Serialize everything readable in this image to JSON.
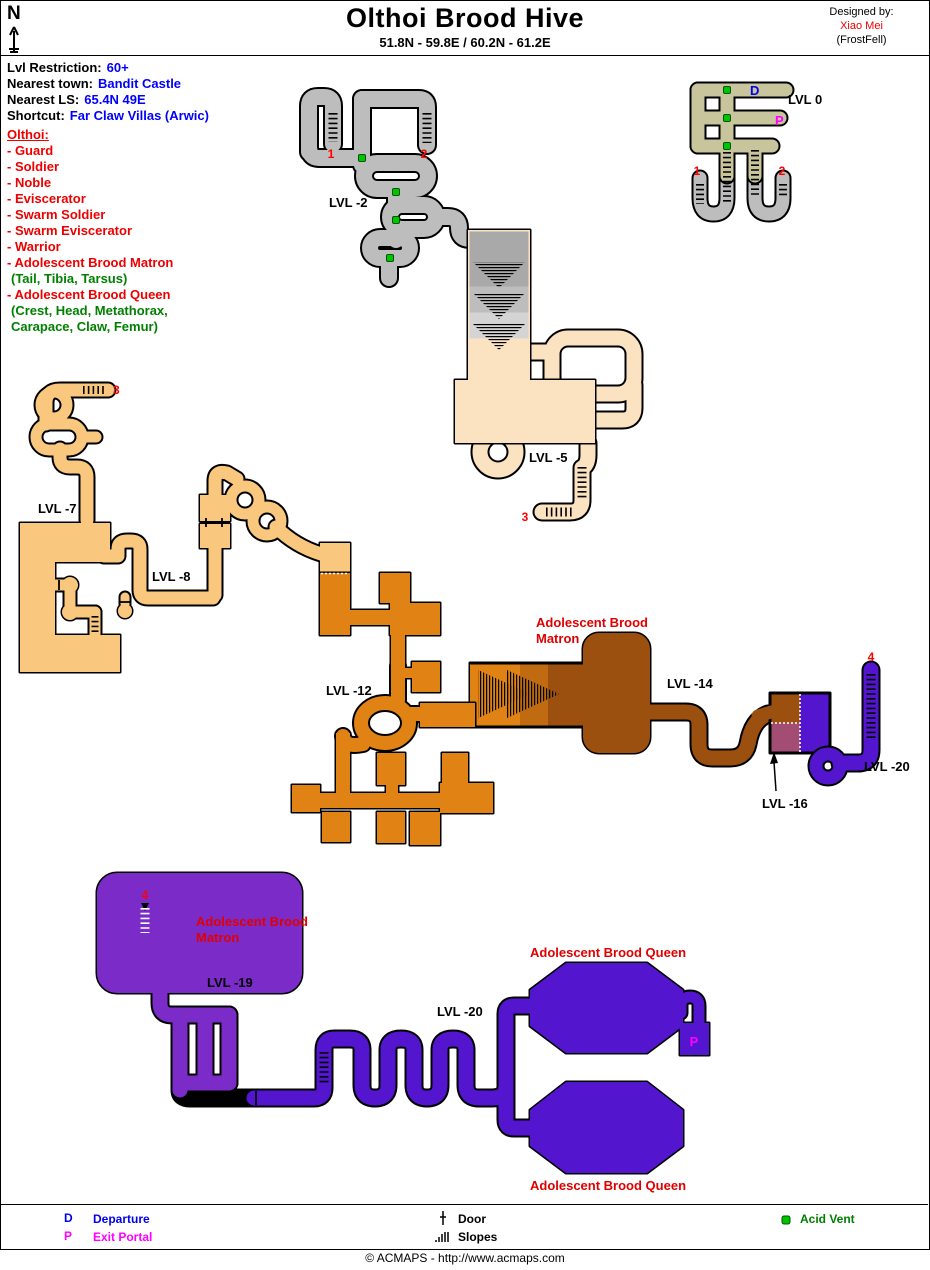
{
  "header": {
    "north_label": "N",
    "title": "Olthoi Brood Hive",
    "subtitle": "51.8N - 59.8E  /  60.2N - 61.2E",
    "designed_by_label": "Designed by:",
    "designer_name": "Xiao Mei",
    "designer_server": "(FrostFell)"
  },
  "info": {
    "restriction_label": "Lvl Restriction:",
    "restriction_value": "60+",
    "town_label": "Nearest town:",
    "town_value": "Bandit Castle",
    "ls_label": "Nearest LS:",
    "ls_value": "65.4N 49E",
    "shortcut_label": "Shortcut:",
    "shortcut_value": "Far Claw Villas (Arwic)",
    "creatures_heading": "Olthoi:",
    "creatures": [
      "- Guard",
      "- Soldier",
      "- Noble",
      "- Eviscerator",
      "- Swarm Soldier",
      "- Swarm Eviscerator",
      "- Warrior",
      "- Adolescent Brood Matron",
      "- Adolescent Brood Queen"
    ],
    "matron_drops": "(Tail, Tibia, Tarsus)",
    "queen_drops_line1": "(Crest, Head, Metathorax,",
    "queen_drops_line2": "Carapace, Claw, Femur)"
  },
  "map": {
    "labels": {
      "lvl0": "LVL 0",
      "lvl2": "LVL -2",
      "lvl5": "LVL -5",
      "lvl7": "LVL -7",
      "lvl8": "LVL -8",
      "lvl12": "LVL -12",
      "lvl14": "LVL -14",
      "lvl16": "LVL -16",
      "lvl19": "LVL -19",
      "lvl20": "LVL -20"
    },
    "area_labels": {
      "matron_line1": "Adolescent Brood",
      "matron_line2": "Matron",
      "queen": "Adolescent Brood Queen"
    },
    "markers": {
      "departure": "D",
      "exit_portal": "P",
      "slope_1": "1",
      "slope_2": "2",
      "slope_3": "3",
      "slope_4": "4"
    }
  },
  "legend": {
    "departure_key": "D",
    "departure_label": "Departure",
    "exit_key": "P",
    "exit_label": "Exit Portal",
    "door_label": "Door",
    "slopes_label": "Slopes",
    "acid_vent_label": "Acid Vent"
  },
  "footer": {
    "copyright": "© ACMAPS - http://www.acmaps.com"
  },
  "colors": {
    "lvl0": "#C8C49C",
    "lvl2": "#BDBDBD",
    "lvl5": "#FBE3C1",
    "lvl7_8": "#F9C87E",
    "lvl12": "#E08214",
    "lvl14": "#9C500F",
    "lvl16": "#A34C74",
    "lvl19": "#7B2CC8",
    "lvl20": "#5316CE",
    "marker_red": "#FF0000",
    "departure_blue": "#0000EE",
    "exit_portal_magenta": "#FF00FF",
    "acid_vent_green": "#00C400",
    "info_blue": "#0000FF",
    "creature_red": "#EE0000",
    "drops_green": "#008000"
  }
}
